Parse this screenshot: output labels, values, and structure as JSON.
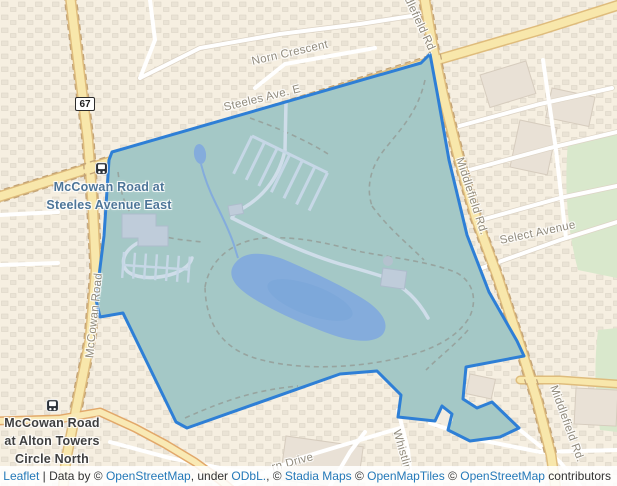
{
  "map": {
    "badge_67": "67",
    "road_labels": {
      "norn_crescent": "Norn Crescent",
      "steeles_ave": "Steeles Ave. E",
      "middlefield_top": "Middlefield Rd.",
      "middlefield_right": "Middlefield Rd.",
      "middlefield_bottom": "Middlefield Rd.",
      "mccowan_road": "McCowan Road",
      "select_avenue": "Select Avenue",
      "whistling": "Whistlin",
      "drive": "rn Drive"
    },
    "stops": {
      "steeles": {
        "line1": "McCowan Road at",
        "line2": "Steeles Avenue East"
      },
      "alton": {
        "line1": "McCowan Road",
        "line2": "at Alton Towers",
        "line3": "Circle North"
      }
    },
    "colors": {
      "base": "#f6efe1",
      "polygon_fill": "#a4c8c6",
      "polygon_stroke": "#2e7fd6",
      "water": "#84acdc",
      "major_road": "#f8e7ab",
      "green_area": "#d9e8cc",
      "link_blue": "#2479b9"
    }
  },
  "attribution": {
    "leaflet": "Leaflet",
    "sep": " | ",
    "t1": "Data by © ",
    "osm1": "OpenStreetMap",
    "t2": ", under ",
    "odbl": "ODbL.",
    "t3": ", © ",
    "stadia": "Stadia Maps",
    "t4": " © ",
    "omt": "OpenMapTiles",
    "t5": " © ",
    "osm2": "OpenStreetMap",
    "t6": " contributors"
  }
}
